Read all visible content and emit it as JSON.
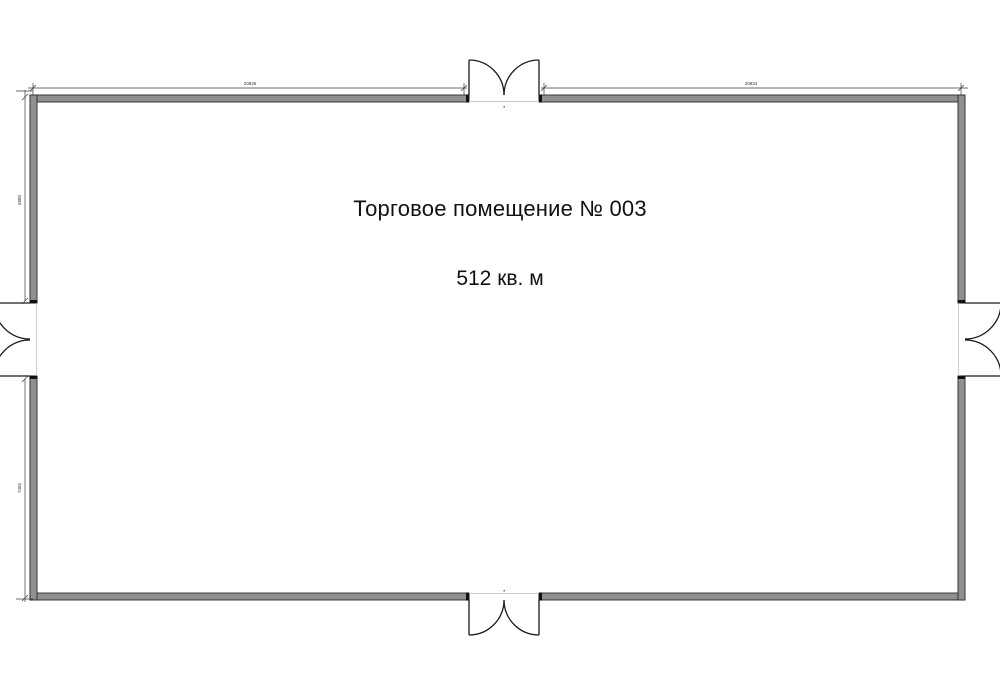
{
  "plan": {
    "room_label": "Торговое помещение № 003",
    "room_area": "512 кв. м",
    "dimensions": {
      "top_left": "20826",
      "top_right": "20834",
      "left_upper": "6880",
      "left_lower": "7465"
    },
    "colors": {
      "wall_fill": "#909090",
      "wall_edge": "#2b2b2b",
      "door_line": "#1a1a1a",
      "dimension_line": "#3c3c3c",
      "threshold_line": "#c8c8c8",
      "text": "#111111",
      "background": "#ffffff"
    }
  }
}
